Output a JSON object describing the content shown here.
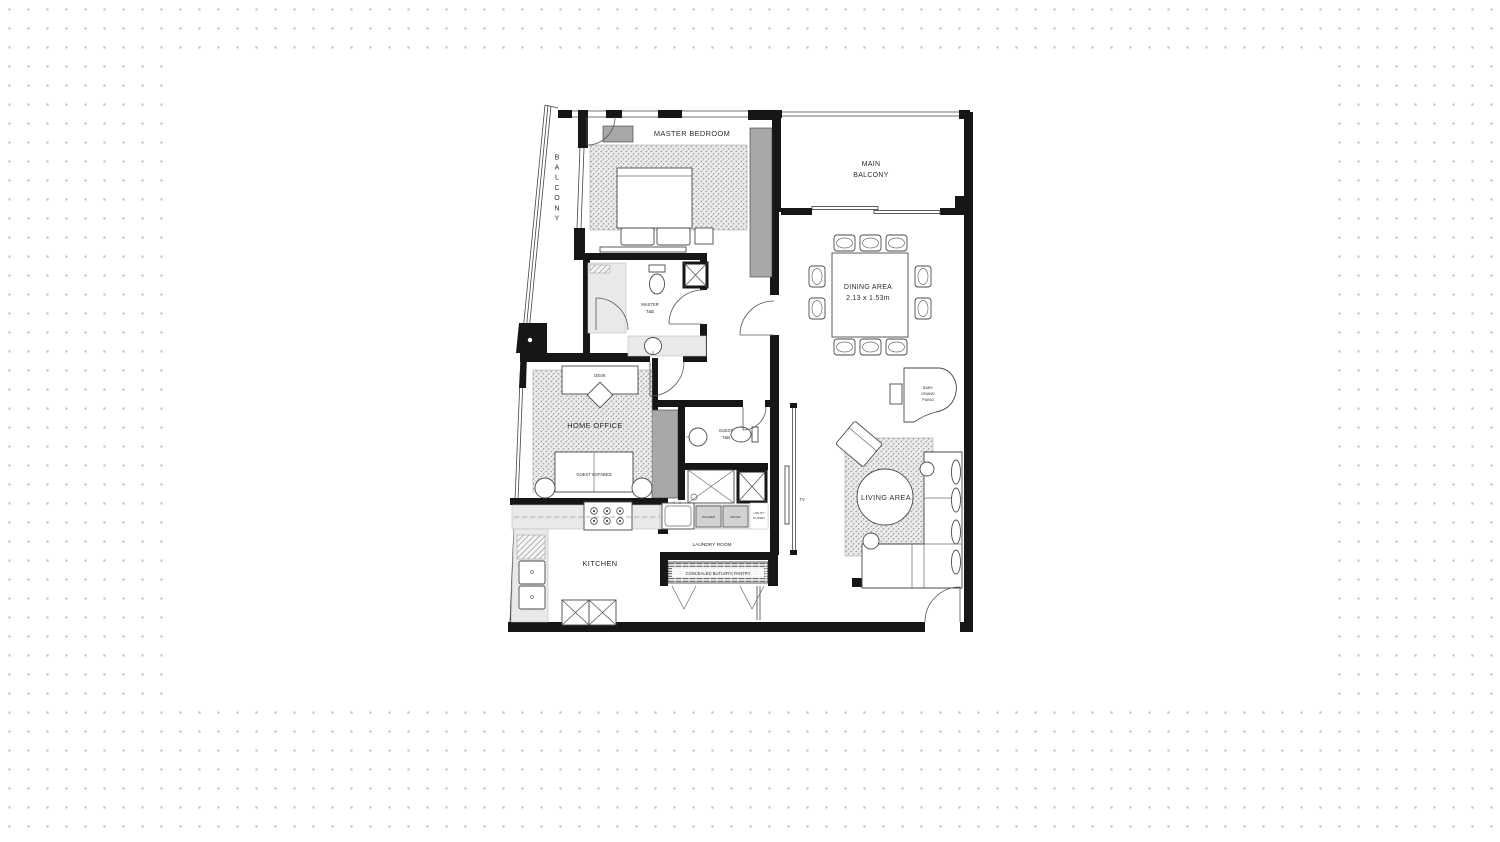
{
  "page": {
    "background_dot_color": "#c4c4c4",
    "canvas_color": "#ffffff",
    "wall_color": "#161616",
    "wardrobe_color": "#a8a8a8",
    "counter_color": "#e9e9e9"
  },
  "floorplan": {
    "labels": {
      "master_bedroom": "MASTER BEDROOM",
      "balcony_side": "BALCONY",
      "main_balcony_1": "MAIN",
      "main_balcony_2": "BALCONY",
      "dining_area": "DINING AREA",
      "dining_size": "2.13 x 1.53m",
      "master_tb_1": "MASTER",
      "master_tb_2": "T&B",
      "desk": "DESK",
      "home_office": "HOME OFFICE",
      "guest_sofabed": "GUEST SOFABED",
      "guest_tb_1": "GUEST",
      "guest_tb_2": "T&B",
      "piano_1": "BABY",
      "piano_2": "GRAND",
      "piano_3": "PIANO",
      "living_area": "LIVING AREA",
      "tv": "TV",
      "kitchen": "KITCHEN",
      "laundry_room": "LAUNDRY ROOM",
      "butlers_pantry": "CONCEALED BUTLER'S PANTRY",
      "washer": "WASHER",
      "dryer": "DRYER",
      "utility_1": "UTILITY",
      "utility_2": "CLOSET"
    }
  }
}
